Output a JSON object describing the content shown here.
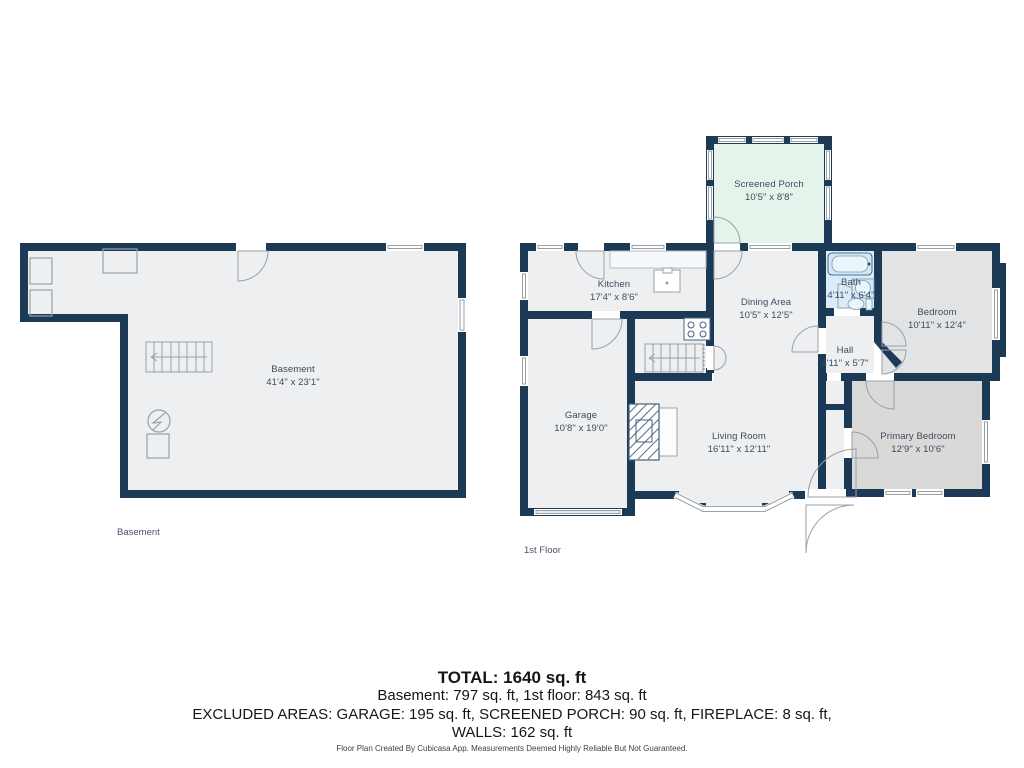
{
  "colors": {
    "wall": "#1c3a55",
    "floor": "#edeff1",
    "bedroom_floor": "#e2e3e5",
    "primary_floor": "#dad9d7",
    "porch_floor": "#e4f4ea",
    "bath_floor": "#d9ecf8",
    "fixture_blue": "#cfe7f8",
    "detail_line": "#9aa0a8",
    "label_text": "#3e4a5f"
  },
  "basement": {
    "floor_label": "Basement",
    "room": {
      "name": "Basement",
      "dims": "41'4\" x 23'1\""
    }
  },
  "first_floor": {
    "floor_label": "1st Floor",
    "rooms": [
      {
        "name": "Screened Porch",
        "dims": "10'5\" x 8'8\""
      },
      {
        "name": "Kitchen",
        "dims": "17'4\" x 8'6\""
      },
      {
        "name": "Dining Area",
        "dims": "10'5\" x 12'5\""
      },
      {
        "name": "Bath",
        "dims": "4'11\" x 6'4\""
      },
      {
        "name": "Bedroom",
        "dims": "10'11\" x 12'4\""
      },
      {
        "name": "Hall",
        "dims": "4'11\" x 5'7\""
      },
      {
        "name": "Garage",
        "dims": "10'8\" x 19'0\""
      },
      {
        "name": "Living Room",
        "dims": "16'11\" x 12'11\""
      },
      {
        "name": "Primary Bedroom",
        "dims": "12'9\" x 10'6\""
      }
    ]
  },
  "summary": {
    "total": "TOTAL: 1640 sq. ft",
    "floors": "Basement: 797 sq. ft, 1st floor: 843 sq. ft",
    "excluded": "EXCLUDED AREAS: GARAGE: 195 sq. ft, SCREENED PORCH: 90 sq. ft, FIREPLACE: 8 sq. ft,",
    "walls": "WALLS: 162 sq. ft"
  },
  "footer": "Floor Plan Created By Cubicasa App. Measurements Deemed Highly Reliable But Not Guaranteed."
}
